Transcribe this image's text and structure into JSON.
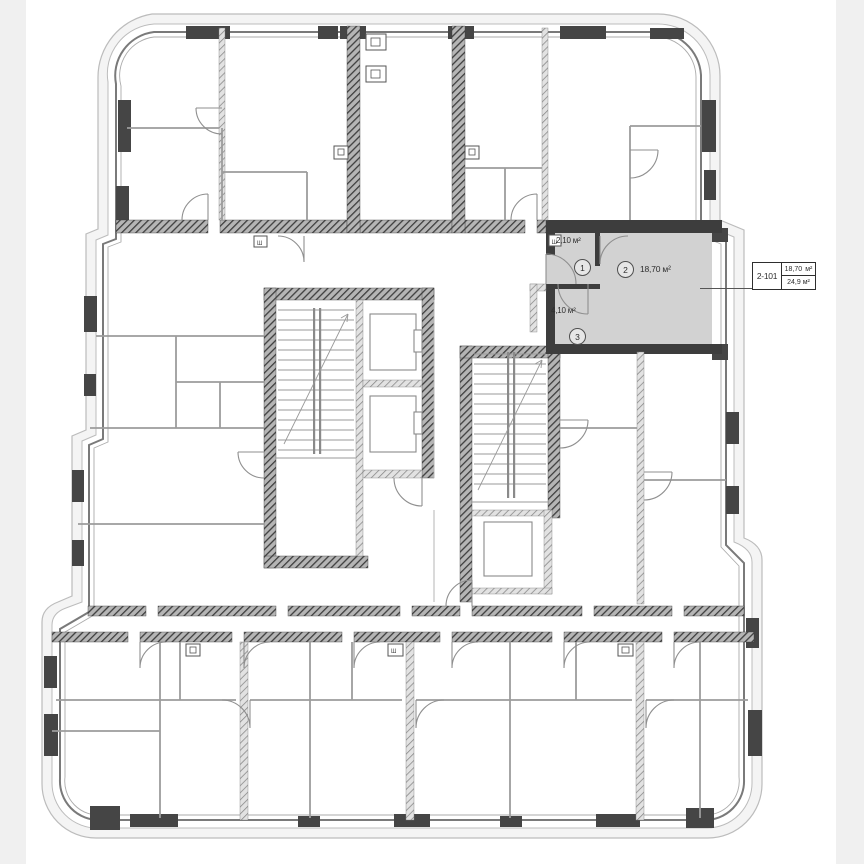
{
  "floor_plan": {
    "unit_highlight": {
      "unit_id": "2-101",
      "rooms": [
        {
          "no": "1",
          "area": "2,10 м²"
        },
        {
          "no": "2",
          "area": "18,70 м²"
        },
        {
          "no": "3",
          "area": "4,10 м²"
        }
      ],
      "callout": {
        "unit_id": "2-101",
        "room_area": "18,70",
        "room_area_unit": "м²",
        "total_area": "24,9 м²"
      }
    },
    "shaft_label": "Ш"
  },
  "colors": {
    "highlight_fill": "#d2d2d2",
    "wall_dark": "#454545",
    "wall_medium": "#8f8f8f",
    "envelope_line": "#bcbcbc",
    "partition": "#9c9c9c",
    "text": "#2e2e2e",
    "callout_border": "#2e2e2e",
    "background": "#ffffff",
    "margin_strip": "#f0f0f0"
  }
}
